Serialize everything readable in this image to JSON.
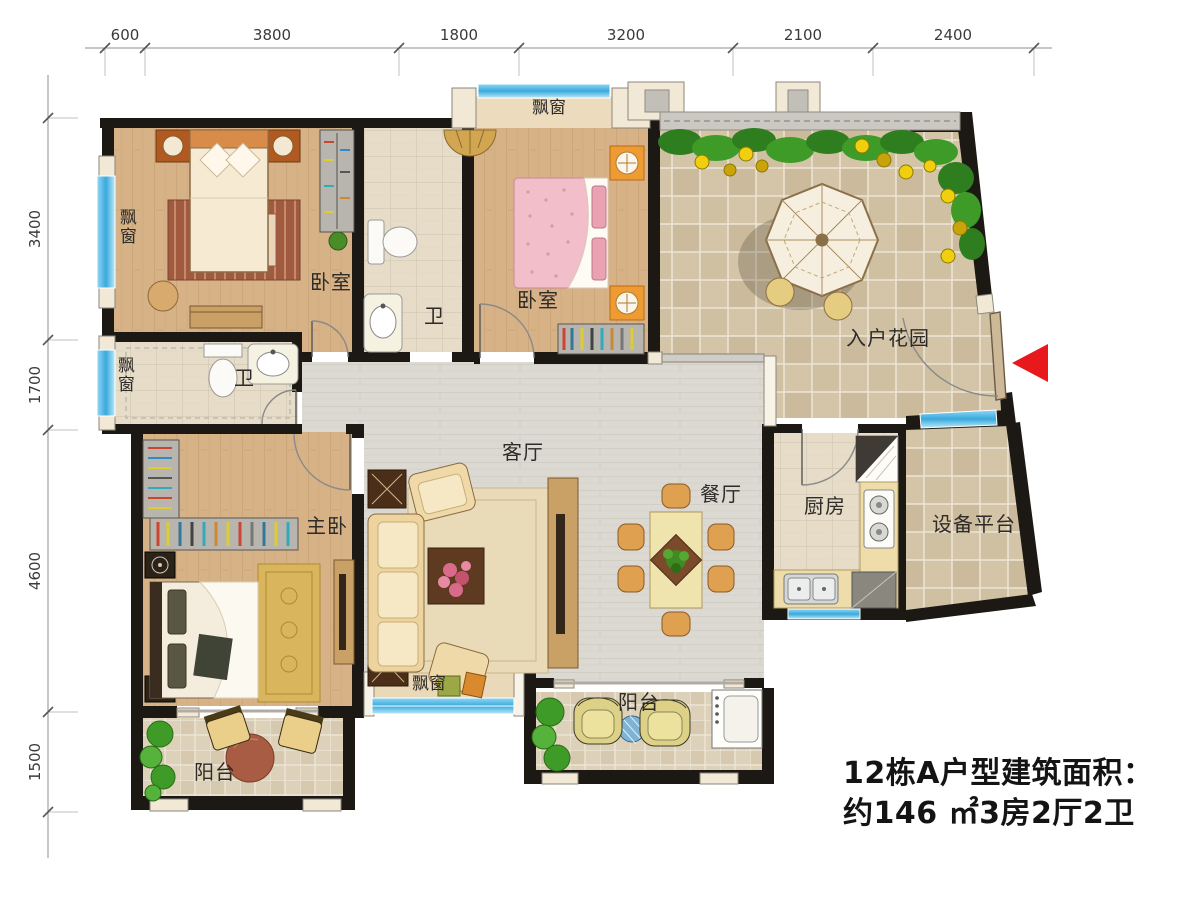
{
  "title_block": {
    "line1": "12栋A户型建筑面积：",
    "line2": "约146 ㎡3房2厅2卫"
  },
  "dimensions": {
    "top": [
      "600",
      "3800",
      "1800",
      "3200",
      "2100",
      "2400"
    ],
    "left": [
      "3400",
      "1700",
      "4600",
      "1500"
    ]
  },
  "labels": {
    "bedroom_top_left": "卧室",
    "bedroom_top_mid": "卧室",
    "master_bedroom": "主卧",
    "living_room": "客厅",
    "dining_room": "餐厅",
    "kitchen": "厨房",
    "entry_garden": "入户花园",
    "equipment_platform": "设备平台",
    "bath_main": "卫",
    "bath_master": "卫",
    "balcony_left": "阳台",
    "balcony_mid": "阳台",
    "bay_left_top": "飘窗",
    "bay_left_mid": "飘窗",
    "bay_top": "飘窗",
    "bay_bottom": "飘窗"
  },
  "colors": {
    "wall": "#1c1813",
    "wood_floor": "#d6b286",
    "plank_floor": "#dcd9d2",
    "tile_floor": "#d4c5a8",
    "window_blue": "#55bdea",
    "sill": "#f2e8d6",
    "entry_arrow_red": "#e8191c"
  }
}
